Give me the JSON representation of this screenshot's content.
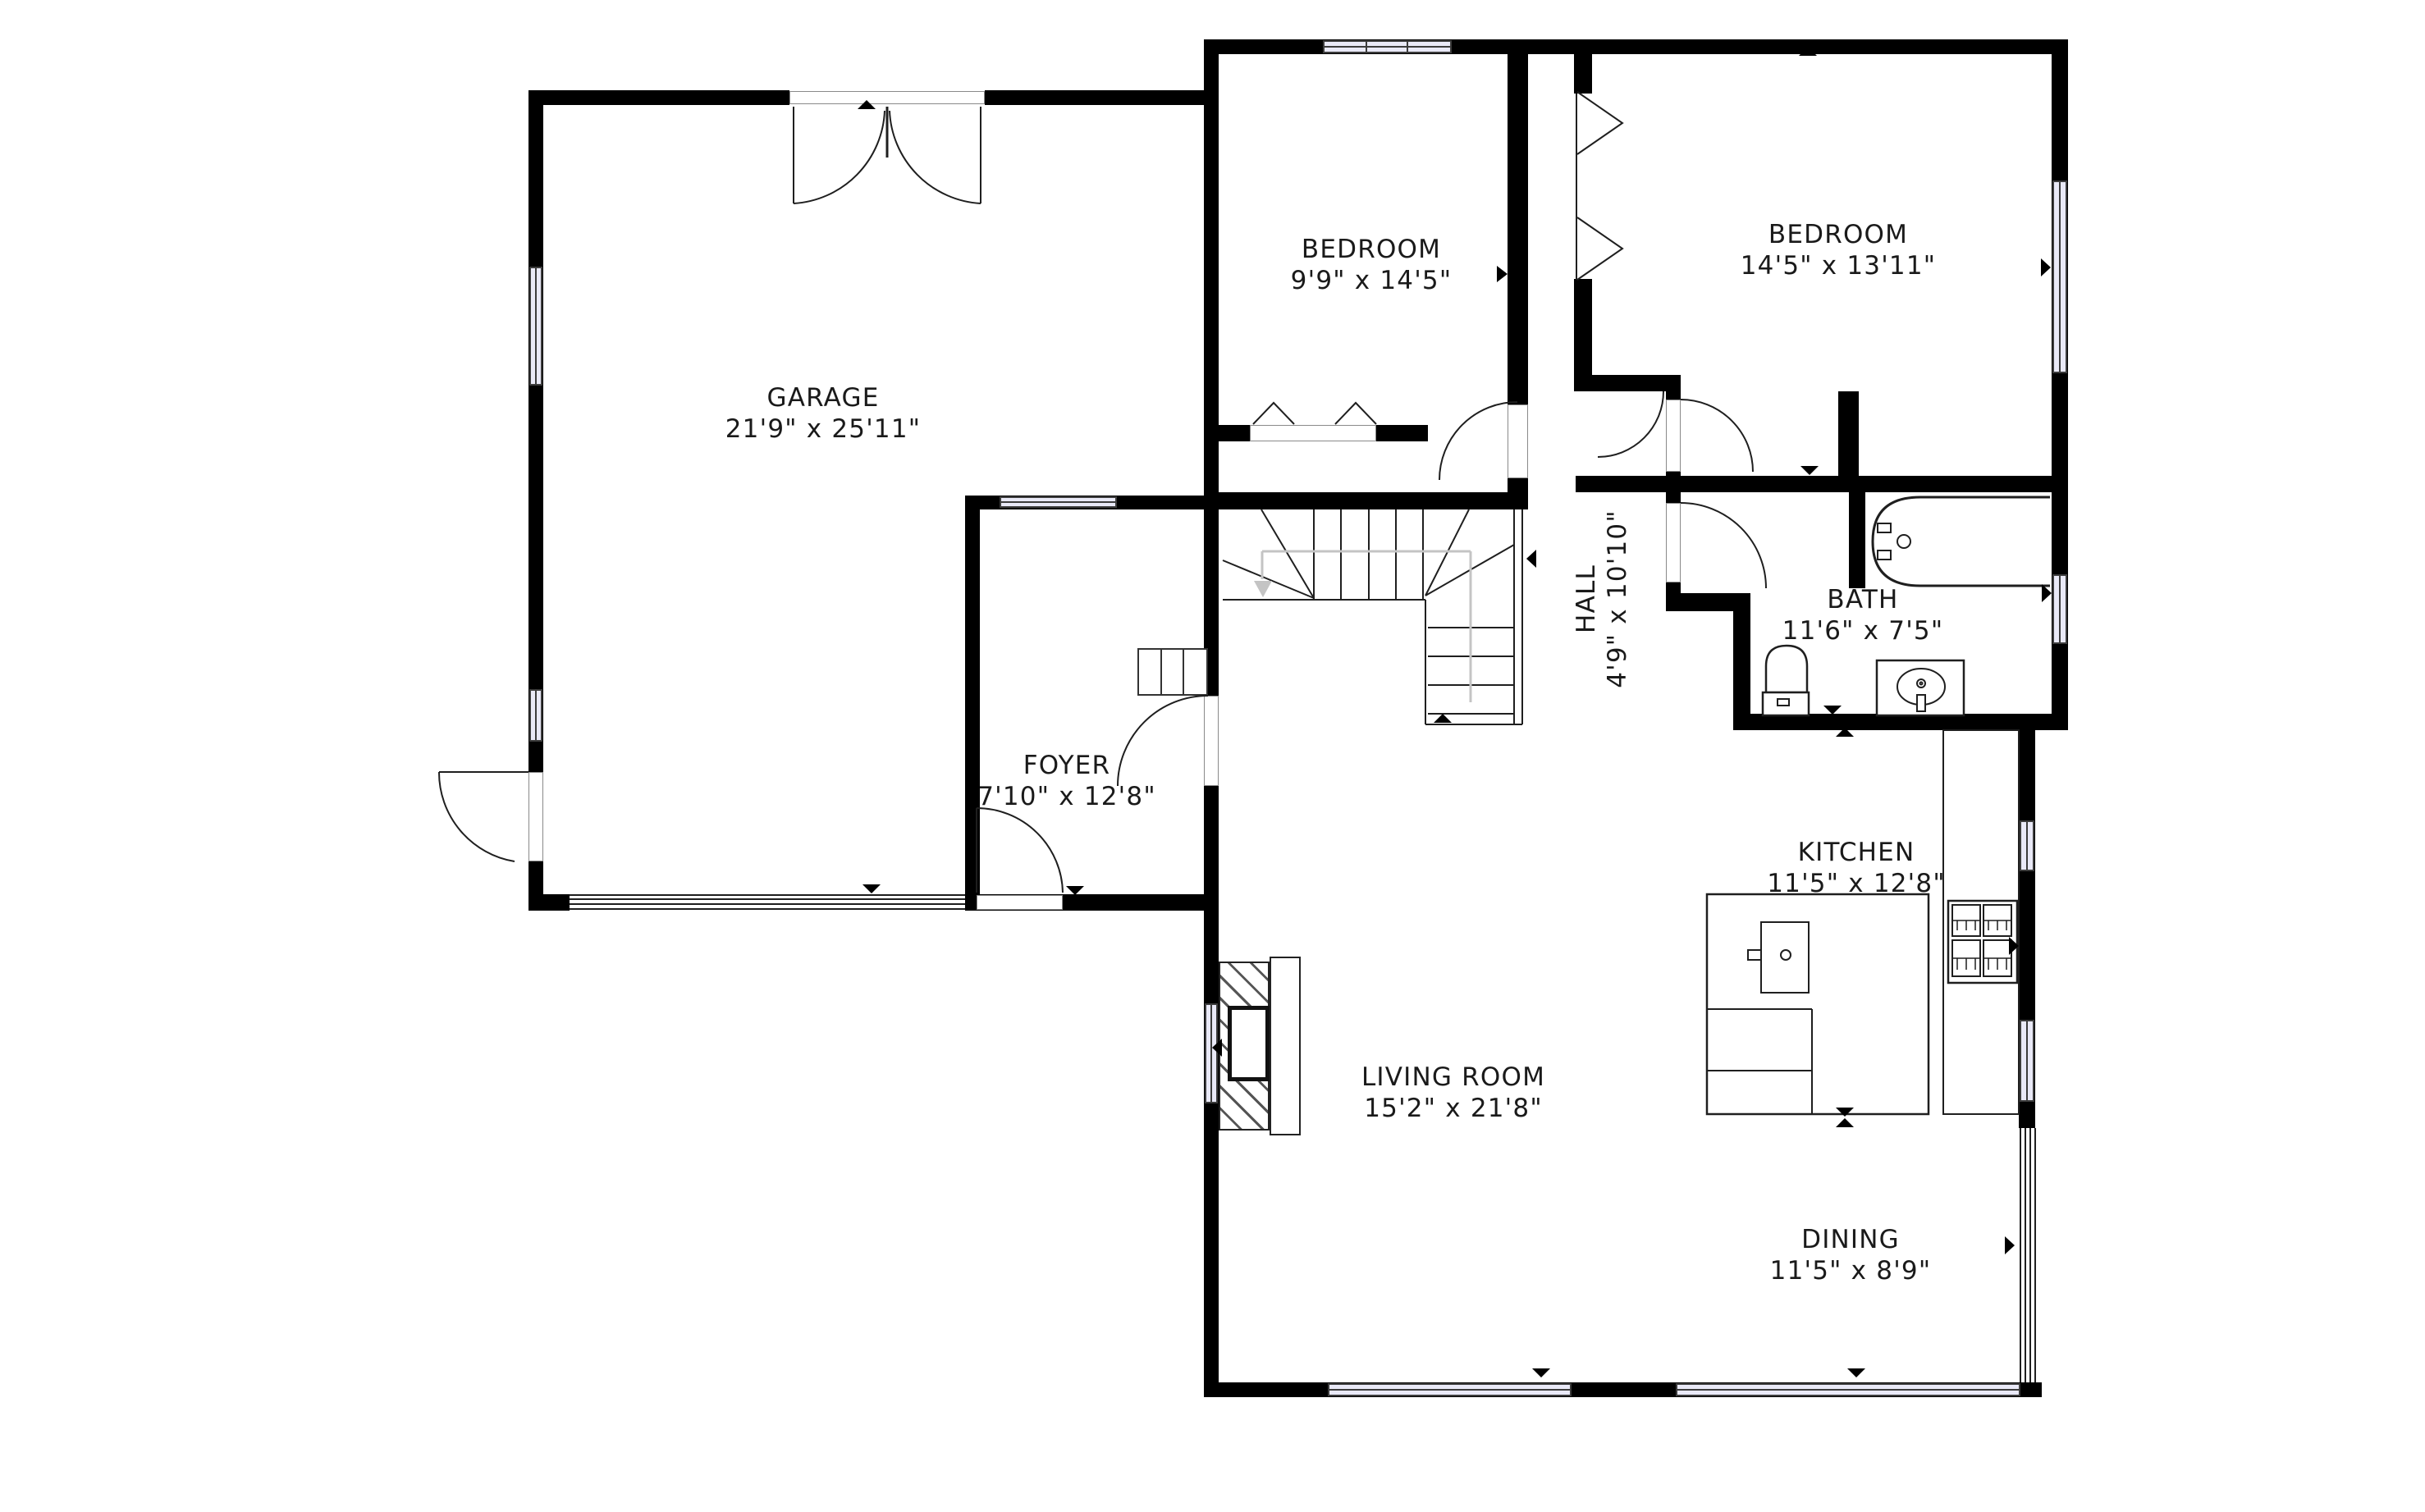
{
  "plan": {
    "type": "residential-floor-plan",
    "floor": "main"
  },
  "colors": {
    "wall": "#000000",
    "window": "#E9E9F7",
    "text": "#1A1A1A",
    "line": "#1F1F1F",
    "guide": "#C4C4C4",
    "background": "#FFFFFF"
  },
  "rooms": [
    {
      "id": "garage",
      "name": "GARAGE",
      "dims": "21'9\" x 25'11\""
    },
    {
      "id": "bedroom1",
      "name": "BEDROOM",
      "dims": "9'9\" x 14'5\""
    },
    {
      "id": "bedroom2",
      "name": "BEDROOM",
      "dims": "14'5\" x 13'11\""
    },
    {
      "id": "hall",
      "name": "HALL",
      "dims": "4'9\" x 10'10\""
    },
    {
      "id": "bath",
      "name": "BATH",
      "dims": "11'6\" x 7'5\""
    },
    {
      "id": "foyer",
      "name": "FOYER",
      "dims": "7'10\" x 12'8\""
    },
    {
      "id": "kitchen",
      "name": "KITCHEN",
      "dims": "11'5\" x 12'8\""
    },
    {
      "id": "living",
      "name": "LIVING ROOM",
      "dims": "15'2\" x 21'8\""
    },
    {
      "id": "dining",
      "name": "DINING",
      "dims": "11'5\" x 8'9\""
    }
  ],
  "fixtures": [
    "bathtub",
    "toilet",
    "vanity-sink",
    "kitchen-island-sink",
    "stove",
    "counter",
    "fireplace",
    "stairs",
    "garage-door",
    "sliding-glass-door",
    "closet-shelves"
  ]
}
